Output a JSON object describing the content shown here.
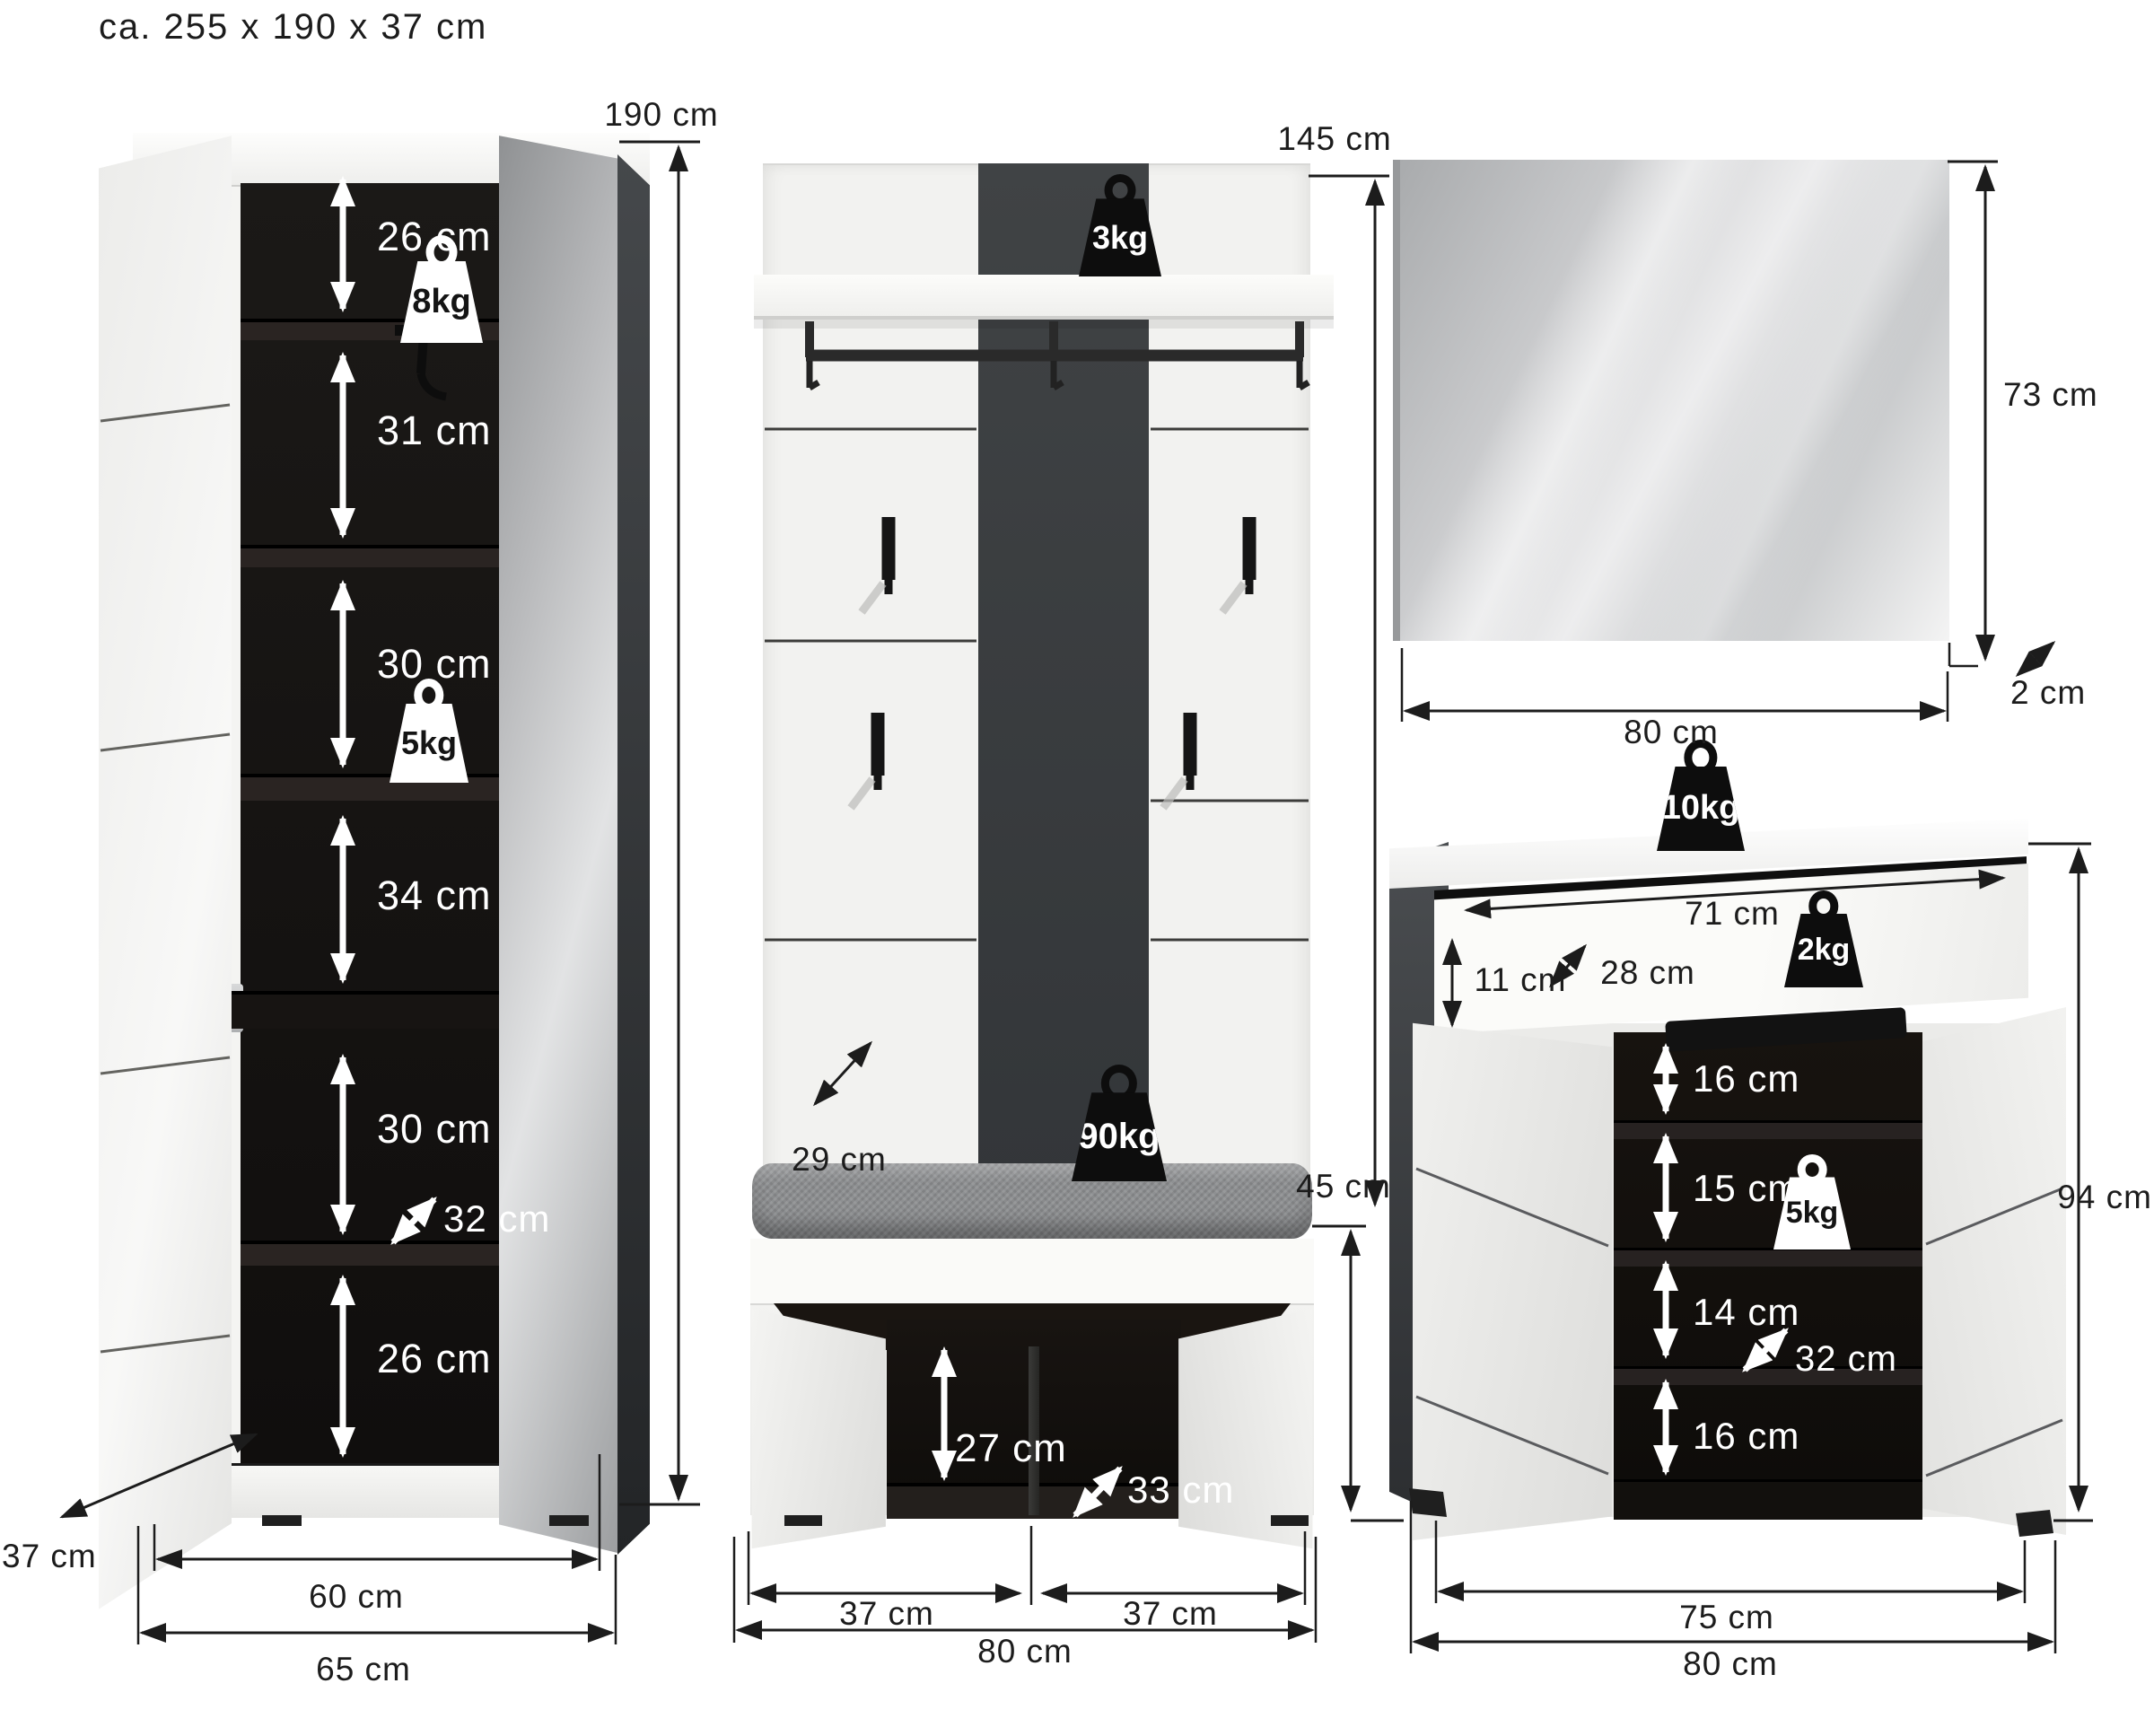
{
  "title": "ca. 255 x 190 x 37 cm",
  "colors": {
    "accent_dark": "#3c3f41",
    "interior_black": "#141110",
    "panel_white": "#f4f4f2"
  },
  "wardrobe": {
    "height": "190 cm",
    "outer_width": "65 cm",
    "inner_width": "60 cm",
    "depth": "37 cm",
    "sections": [
      "26 cm",
      "31 cm",
      "30 cm",
      "34 cm",
      "30 cm",
      "26 cm"
    ],
    "inner_depth": "32 cm",
    "shelf_load_top": "8kg",
    "shelf_load_mid": "5kg"
  },
  "coatrack": {
    "height": "145 cm",
    "panel_depth": "29 cm",
    "shelf_load": "3kg",
    "bench_load": "90kg",
    "bench_height": "45 cm",
    "bench_inner_height": "27 cm",
    "bench_inner_depth": "33 cm",
    "left_door_width": "37 cm",
    "right_door_width": "37 cm",
    "total_width": "80 cm"
  },
  "mirror": {
    "height": "73 cm",
    "width": "80 cm",
    "depth": "2 cm"
  },
  "cabinet": {
    "top_load": "10kg",
    "drawer_width": "71 cm",
    "drawer_height": "11 cm",
    "drawer_depth": "28 cm",
    "drawer_load": "2kg",
    "shelves": [
      "16 cm",
      "15 cm",
      "14 cm",
      "16 cm"
    ],
    "shelf_load": "5kg",
    "inner_depth": "32 cm",
    "height": "94 cm",
    "inner_width": "75 cm",
    "total_width": "80 cm"
  }
}
